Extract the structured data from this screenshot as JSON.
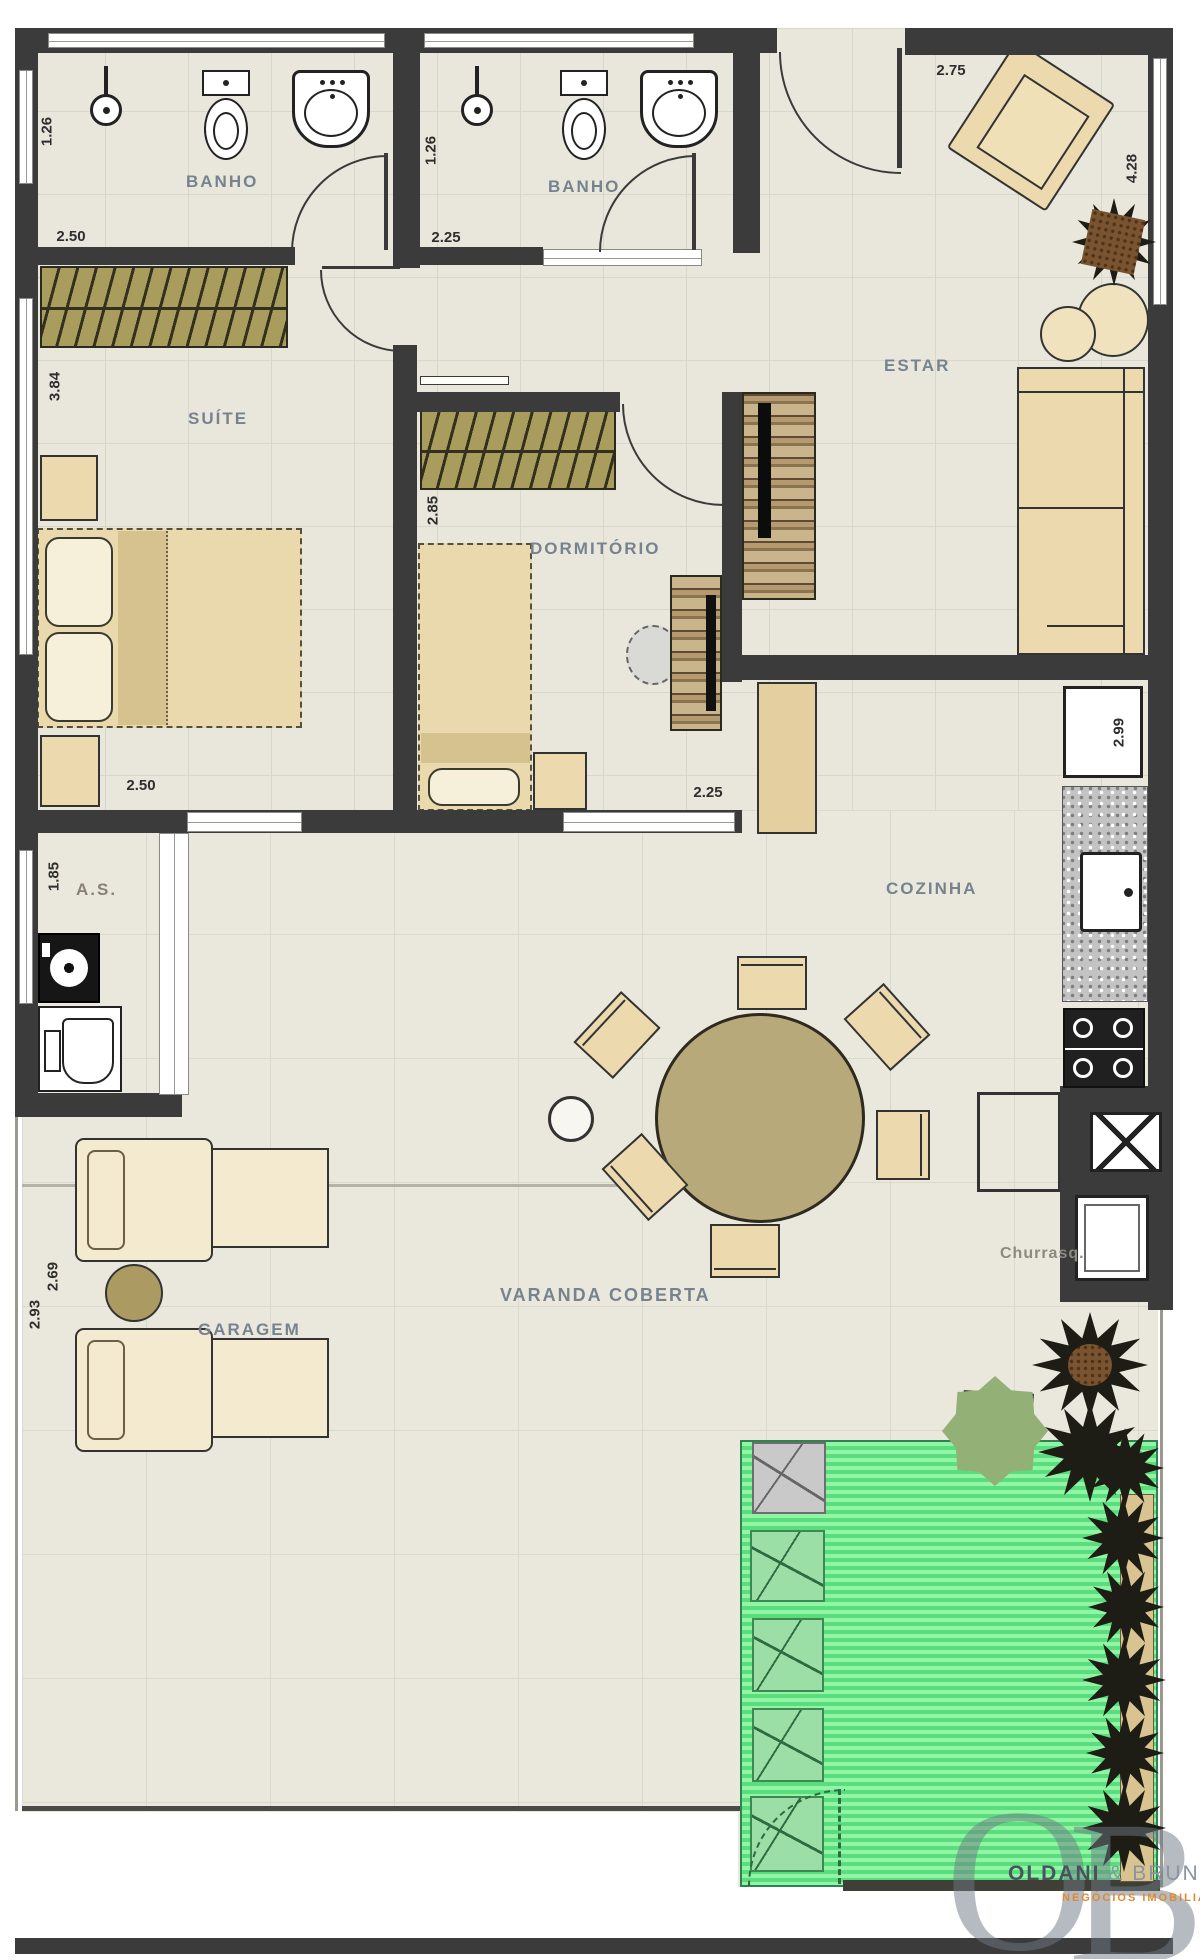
{
  "document_type": "apartment floor plan",
  "rooms": {
    "banho1": "BANHO",
    "banho2": "BANHO",
    "suite": "SUÍTE",
    "dormitorio": "DORMITÓRIO",
    "estar": "ESTAR",
    "cozinha": "COZINHA",
    "area_servico": "A.S.",
    "varanda": "VARANDA COBERTA",
    "garagem": "GARAGEM",
    "churrasqueira": "Churrasq."
  },
  "dims": {
    "banho1_width": "1.26",
    "banho1_length": "2.50",
    "banho2_width": "1.26",
    "banho2_length": "2.25",
    "entry_width": "2.75",
    "estar_length": "4.28",
    "suite_length": "3.84",
    "suite_width": "2.50",
    "dorm_length": "2.85",
    "dorm_width": "2.25",
    "cozinha_length": "2.99",
    "as_length": "1.85",
    "varanda_width": "2.69",
    "garagem_width": "2.93"
  },
  "logo": {
    "monogram_o": "O",
    "monogram_b": "B",
    "name_bold": "OLDANI",
    "amp": "&",
    "name_light": "BRUNNER",
    "tagline": "NEGÓCIOS IMOBILIÁRIOS"
  },
  "colors": {
    "wall": "#3b3b3b",
    "floor": "#e9e7dc",
    "furniture": "#ecd9ae",
    "lawn": "#5cdd7d",
    "label": "#76838f",
    "tagline_orange": "#e0892e"
  }
}
